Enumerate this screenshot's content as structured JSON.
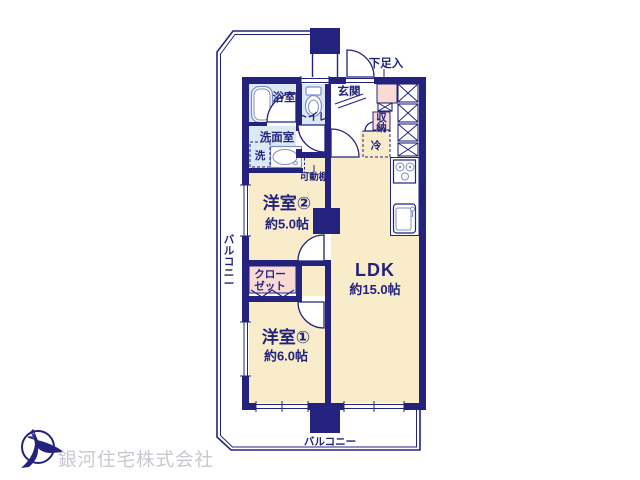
{
  "colors": {
    "navy": "#23237d",
    "cream": "#f8ecca",
    "wet": "#dbe9f5",
    "pink": "#f9dbd3",
    "fixture": "#7f8dc4",
    "company-gray": "#c8c8cf",
    "white": "#ffffff"
  },
  "floorplan": {
    "rooms": {
      "western2": {
        "name": "洋室②",
        "area": "約5.0帖"
      },
      "ldk": {
        "name": "LDK",
        "area": "約15.0帖"
      },
      "western1": {
        "name": "洋室①",
        "area": "約6.0帖"
      }
    },
    "labels": {
      "bath": "浴室",
      "toilet": "トイレ",
      "washroom": "洗面室",
      "washer": "洗",
      "genkan": "玄関",
      "shoe_box": "下足入",
      "storage": "収納",
      "fridge": "冷",
      "movable_shelf": "可動棚",
      "closet_line1": "クロー",
      "closet_line2": "ゼット",
      "balcony_left": "バルコニー",
      "balcony_bottom": "バルコニー"
    }
  },
  "footer": {
    "company_name": "銀河住宅株式会社"
  }
}
